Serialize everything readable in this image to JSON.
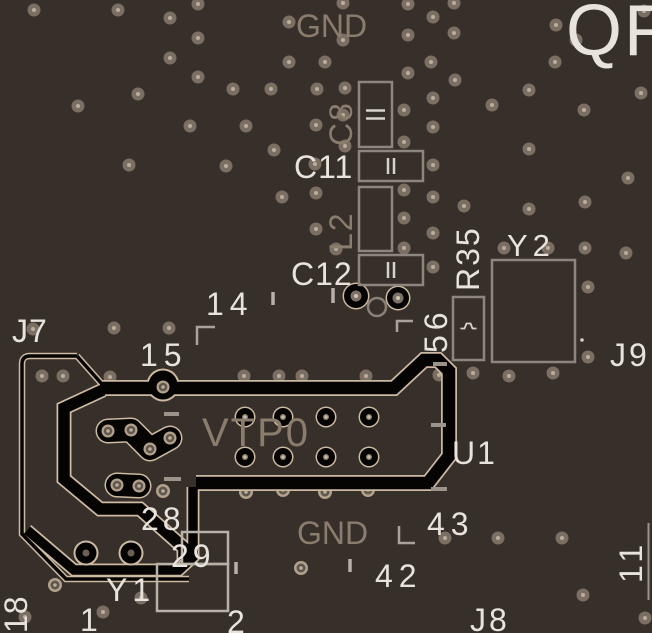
{
  "board_title": "QF",
  "colors": {
    "background": "#372f2a",
    "silk_bright": "#e8e4dd",
    "silk_dim": "#8a7d6e",
    "outline_gray": "#8d867e",
    "outline_light": "#b8b1a7",
    "keepout_black": "#060402",
    "keepout_edge_tan": "#ccbaa3",
    "via_ring": "#7b6f64",
    "via_dot": "#bbad9c",
    "halo_ring": "#b2a18b",
    "halo_core": "#5f564d",
    "symbol_stroke": "#d8d3ca"
  },
  "silkscreen_labels": [
    {
      "id": "qf",
      "text": "QF",
      "x": 566,
      "y": 55,
      "size": 72,
      "tone": "bright",
      "rot": 0,
      "ls": 2
    },
    {
      "id": "gnd-top",
      "text": "GND",
      "x": 296,
      "y": 37,
      "size": 32,
      "tone": "dim",
      "rot": 0,
      "ls": 0
    },
    {
      "id": "c8",
      "text": "C8",
      "x": 352,
      "y": 146,
      "size": 32,
      "tone": "dim",
      "rot": -90,
      "ls": 2
    },
    {
      "id": "c11",
      "text": "C11",
      "x": 294,
      "y": 178,
      "size": 32,
      "tone": "bright",
      "rot": 0,
      "ls": 1
    },
    {
      "id": "l2",
      "text": "L2",
      "x": 352,
      "y": 251,
      "size": 32,
      "tone": "dim",
      "rot": -90,
      "ls": 2
    },
    {
      "id": "c12",
      "text": "C12",
      "x": 291,
      "y": 285,
      "size": 32,
      "tone": "bright",
      "rot": 0,
      "ls": 1
    },
    {
      "id": "r35",
      "text": "R35",
      "x": 479,
      "y": 291,
      "size": 32,
      "tone": "bright",
      "rot": -90,
      "ls": 2
    },
    {
      "id": "n56",
      "text": "56",
      "x": 447,
      "y": 353,
      "size": 32,
      "tone": "bright",
      "rot": -90,
      "ls": 5
    },
    {
      "id": "y2",
      "text": "Y2",
      "x": 507,
      "y": 256,
      "size": 31,
      "tone": "bright",
      "rot": 0,
      "ls": 5
    },
    {
      "id": "j9",
      "text": "J9",
      "x": 610,
      "y": 366,
      "size": 32,
      "tone": "bright",
      "rot": 0,
      "ls": 3
    },
    {
      "id": "n14",
      "text": "14",
      "x": 206,
      "y": 315,
      "size": 32,
      "tone": "bright",
      "rot": 0,
      "ls": 6
    },
    {
      "id": "n15",
      "text": "15",
      "x": 140,
      "y": 366,
      "size": 32,
      "tone": "bright",
      "rot": 0,
      "ls": 6
    },
    {
      "id": "j7",
      "text": "J7",
      "x": 12,
      "y": 342,
      "size": 32,
      "tone": "bright",
      "rot": 0,
      "ls": 1
    },
    {
      "id": "vtp0",
      "text": "VTP0",
      "x": 202,
      "y": 446,
      "size": 40,
      "tone": "dim",
      "rot": 0,
      "ls": 2
    },
    {
      "id": "u1",
      "text": "U1",
      "x": 452,
      "y": 464,
      "size": 32,
      "tone": "bright",
      "rot": 0,
      "ls": 2
    },
    {
      "id": "gnd-bottom",
      "text": "GND",
      "x": 297,
      "y": 544,
      "size": 32,
      "tone": "dim",
      "rot": 0,
      "ls": 0
    },
    {
      "id": "n43",
      "text": "43",
      "x": 427,
      "y": 535,
      "size": 32,
      "tone": "bright",
      "rot": 0,
      "ls": 6
    },
    {
      "id": "n42",
      "text": "42",
      "x": 375,
      "y": 587,
      "size": 32,
      "tone": "bright",
      "rot": 0,
      "ls": 6
    },
    {
      "id": "n28",
      "text": "28",
      "x": 141,
      "y": 530,
      "size": 32,
      "tone": "bright",
      "rot": 0,
      "ls": 4
    },
    {
      "id": "n29",
      "text": "29",
      "x": 171,
      "y": 567,
      "size": 32,
      "tone": "bright",
      "rot": 0,
      "ls": 4
    },
    {
      "id": "y1",
      "text": "Y1",
      "x": 106,
      "y": 601,
      "size": 32,
      "tone": "bright",
      "rot": 0,
      "ls": 5
    },
    {
      "id": "n1",
      "text": "1",
      "x": 80,
      "y": 631,
      "size": 32,
      "tone": "bright",
      "rot": 0,
      "ls": 0
    },
    {
      "id": "n2",
      "text": "2",
      "x": 227,
      "y": 633,
      "size": 32,
      "tone": "bright",
      "rot": 0,
      "ls": 0
    },
    {
      "id": "n18",
      "text": "18",
      "x": 27,
      "y": 633,
      "size": 32,
      "tone": "bright",
      "rot": -90,
      "ls": 1
    },
    {
      "id": "n11",
      "text": "11",
      "x": 642,
      "y": 583,
      "size": 32,
      "tone": "bright",
      "rot": -90,
      "ls": 5
    },
    {
      "id": "j8",
      "text": "J8",
      "x": 470,
      "y": 631,
      "size": 32,
      "tone": "bright",
      "rot": 0,
      "ls": 3
    }
  ],
  "components": [
    {
      "ref": "C8",
      "x": 359,
      "y": 82,
      "w": 33,
      "h": 65,
      "symbol": "cap-h",
      "tone": "gray"
    },
    {
      "ref": "C11",
      "x": 359,
      "y": 151,
      "w": 64,
      "h": 30,
      "symbol": "cap-v",
      "tone": "gray"
    },
    {
      "ref": "L2",
      "x": 359,
      "y": 187,
      "w": 33,
      "h": 64,
      "symbol": "none",
      "tone": "gray"
    },
    {
      "ref": "C12",
      "x": 359,
      "y": 255,
      "w": 64,
      "h": 30,
      "symbol": "cap-v",
      "tone": "gray"
    },
    {
      "ref": "R35",
      "x": 453,
      "y": 297,
      "w": 31,
      "h": 63,
      "symbol": "res",
      "tone": "gray"
    },
    {
      "ref": "Y2",
      "x": 492,
      "y": 260,
      "w": 83,
      "h": 102,
      "symbol": "none",
      "tone": "gray"
    },
    {
      "ref": "Y1",
      "x": 157,
      "y": 564,
      "w": 71,
      "h": 47,
      "symbol": "none",
      "tone": "light"
    },
    {
      "ref": "Y1b",
      "x": 182,
      "y": 532,
      "w": 46,
      "h": 32,
      "symbol": "none",
      "tone": "light"
    }
  ],
  "vias_standard": [
    [
      34,
      10
    ],
    [
      118,
      10
    ],
    [
      170,
      18
    ],
    [
      198,
      4
    ],
    [
      289,
      22
    ],
    [
      198,
      38
    ],
    [
      170,
      58
    ],
    [
      289,
      62
    ],
    [
      325,
      62
    ],
    [
      198,
      77
    ],
    [
      233,
      89
    ],
    [
      271,
      89
    ],
    [
      317,
      89
    ],
    [
      138,
      94
    ],
    [
      78,
      106
    ],
    [
      316,
      125
    ],
    [
      190,
      126
    ],
    [
      246,
      126
    ],
    [
      274,
      150
    ],
    [
      315,
      164
    ],
    [
      129,
      165
    ],
    [
      226,
      166
    ],
    [
      282,
      197
    ],
    [
      316,
      193
    ],
    [
      316,
      229
    ],
    [
      343,
      3
    ],
    [
      408,
      4
    ],
    [
      454,
      3
    ],
    [
      433,
      17
    ],
    [
      556,
      25
    ],
    [
      576,
      40
    ],
    [
      644,
      11
    ],
    [
      343,
      40
    ],
    [
      408,
      35
    ],
    [
      454,
      33
    ],
    [
      555,
      62
    ],
    [
      408,
      73
    ],
    [
      431,
      62
    ],
    [
      455,
      80
    ],
    [
      345,
      88
    ],
    [
      433,
      98
    ],
    [
      492,
      105
    ],
    [
      529,
      90
    ],
    [
      584,
      110
    ],
    [
      641,
      93
    ],
    [
      404,
      110
    ],
    [
      343,
      115
    ],
    [
      433,
      127
    ],
    [
      404,
      142
    ],
    [
      345,
      146
    ],
    [
      433,
      165
    ],
    [
      529,
      149
    ],
    [
      628,
      178
    ],
    [
      404,
      190
    ],
    [
      433,
      197
    ],
    [
      464,
      206
    ],
    [
      529,
      209
    ],
    [
      585,
      202
    ],
    [
      404,
      218
    ],
    [
      433,
      233
    ],
    [
      404,
      248
    ],
    [
      504,
      248
    ],
    [
      548,
      248
    ],
    [
      585,
      248
    ],
    [
      626,
      253
    ],
    [
      336,
      249
    ],
    [
      433,
      267
    ],
    [
      588,
      287
    ],
    [
      33,
      329
    ],
    [
      114,
      328
    ],
    [
      169,
      328
    ],
    [
      42,
      376
    ],
    [
      63,
      376
    ],
    [
      110,
      377
    ],
    [
      244,
      376
    ],
    [
      279,
      376
    ],
    [
      302,
      376
    ],
    [
      366,
      376
    ],
    [
      439,
      375
    ],
    [
      473,
      373
    ],
    [
      509,
      376
    ],
    [
      553,
      373
    ],
    [
      588,
      357
    ],
    [
      445,
      538
    ],
    [
      498,
      538
    ],
    [
      562,
      538
    ],
    [
      583,
      595
    ],
    [
      645,
      618
    ],
    [
      25,
      617
    ],
    [
      103,
      612
    ],
    [
      141,
      598
    ]
  ],
  "vias_halo": [
    [
      163,
      491
    ],
    [
      246,
      492
    ],
    [
      283,
      490
    ],
    [
      325,
      492
    ],
    [
      368,
      490
    ],
    [
      55,
      585
    ],
    [
      301,
      568
    ]
  ],
  "connector": {
    "island_pads": [
      [
        245,
        417
      ],
      [
        283,
        417
      ],
      [
        326,
        417
      ],
      [
        369,
        417
      ],
      [
        245,
        457
      ],
      [
        283,
        457
      ],
      [
        326,
        457
      ],
      [
        369,
        457
      ]
    ],
    "boot_pads": [
      [
        86,
        553
      ],
      [
        131,
        553
      ]
    ],
    "round_pads": [
      [
        356,
        296,
        12
      ],
      [
        398,
        298,
        11
      ]
    ],
    "gray_ring": [
      377,
      307,
      9
    ],
    "blob1": [
      [
        108,
        431
      ],
      [
        131,
        430
      ],
      [
        150,
        449
      ],
      [
        170,
        438
      ]
    ],
    "blob2": [
      [
        117,
        485
      ],
      [
        139,
        486
      ]
    ],
    "pin15_via": [
      163,
      387
    ]
  },
  "marks": {
    "ticks_v": [
      [
        273,
        292,
        13
      ],
      [
        333,
        288,
        15
      ],
      [
        350,
        559,
        13
      ],
      [
        236,
        562,
        12
      ]
    ],
    "ticks_h": [
      [
        164,
        414,
        15
      ],
      [
        164,
        479,
        17
      ],
      [
        431,
        425,
        15
      ],
      [
        431,
        489,
        16
      ],
      [
        433,
        364,
        14
      ]
    ],
    "brackets": [
      {
        "points": "197,345 197,327 215,327"
      },
      {
        "points": "397,332 397,321 413,321"
      },
      {
        "points": "399,526 399,543 415,543"
      }
    ],
    "edge_line": {
      "x": 648.5,
      "y1": 523,
      "y2": 600
    },
    "white_dot": [
      582,
      340
    ]
  }
}
